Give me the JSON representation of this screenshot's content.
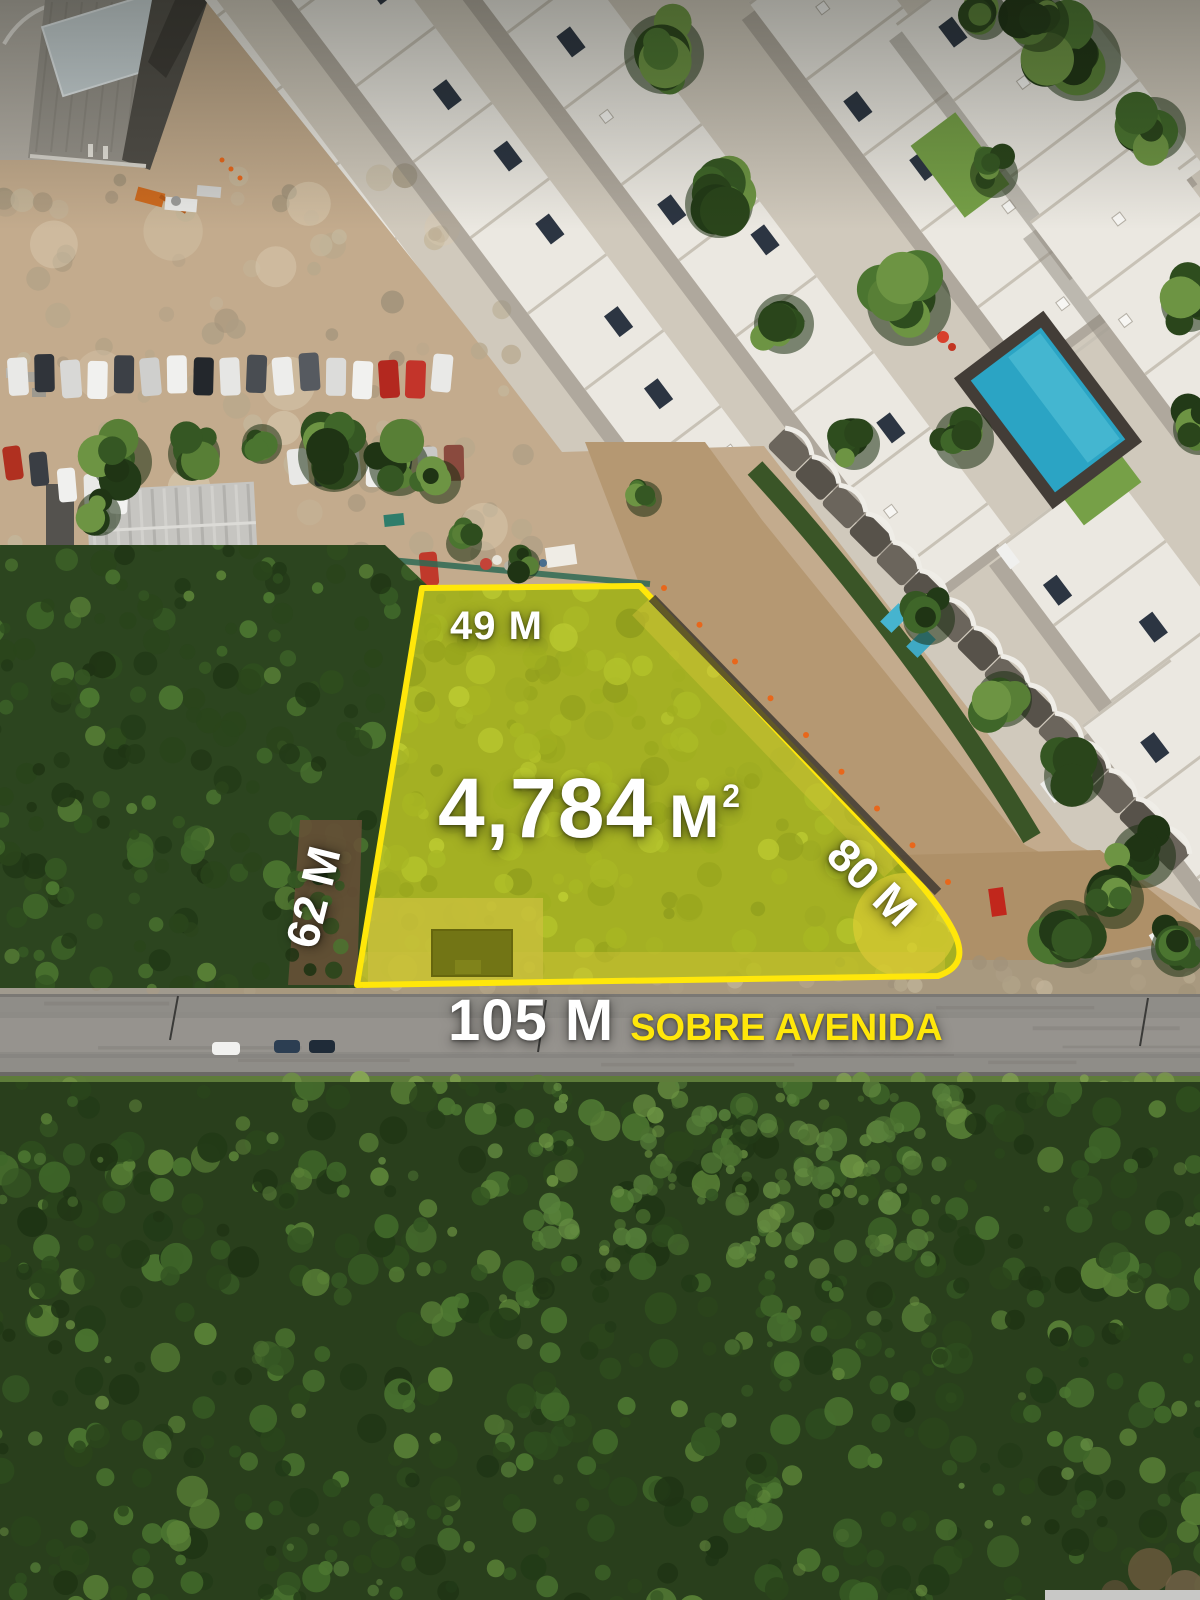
{
  "colors": {
    "boundary": "#ffe70a",
    "label_text": "#ffffff",
    "street_label_text": "#ffe70a"
  },
  "plot": {
    "top_length": "49 M",
    "left_length": "62 M",
    "right_length": "80 M",
    "area_value": "4,784",
    "area_unit": "M",
    "area_exponent": "2",
    "frontage_length": "105 M",
    "frontage_street": "SOBRE AVENIDA"
  }
}
